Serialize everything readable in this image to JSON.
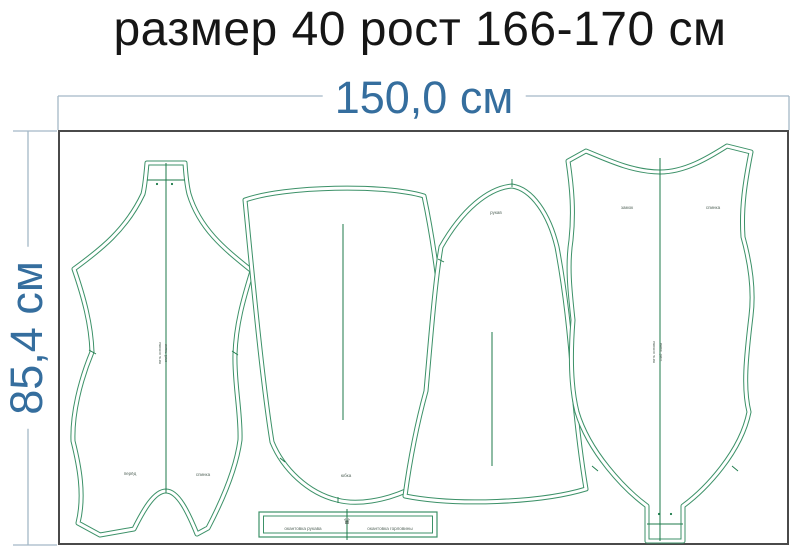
{
  "title": "размер 40 рост 166-170 см",
  "sheet": {
    "width_label": "150,0 см",
    "height_label": "85,4 см"
  },
  "colors": {
    "title_black": "#161616",
    "dimension_blue": "#356e9e",
    "dimension_line": "#a3b8c6",
    "border_gray": "#4a4a4a",
    "pattern_green": "#3c9168",
    "pattern_dark_green": "#1c7a4a",
    "label_gray": "#55665c"
  },
  "pieces": {
    "front": {
      "label_left": "перёд",
      "label_right": "спинка",
      "grain_1": "нить основы",
      "grain_2": "сгиб ткани"
    },
    "skirt": {
      "label": "юбка"
    },
    "sleeve": {
      "label": "рукав"
    },
    "back": {
      "label_left": "замок",
      "label_right": "спинка",
      "grain_1": "нить основы",
      "grain_2": "сгиб ткани"
    },
    "binding_strip": {
      "label_left": "окантовка рукава",
      "label_right": "окантовка горловины",
      "logo_glyph": "♛"
    }
  }
}
